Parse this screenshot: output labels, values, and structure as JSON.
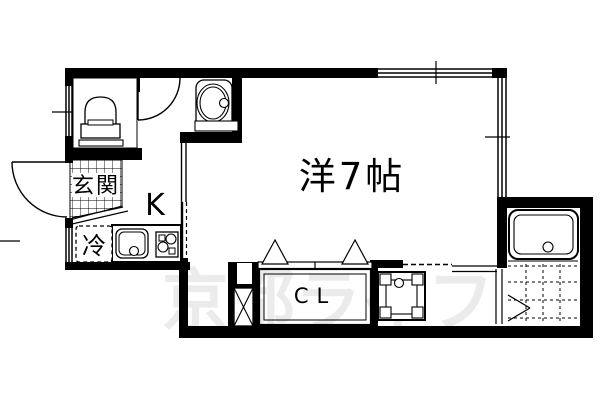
{
  "floor_plan": {
    "watermark": "京都ライフ",
    "rooms": {
      "main_room": {
        "label": "洋7帖"
      },
      "kitchen": {
        "label": "K"
      },
      "entrance": {
        "label": "玄関"
      },
      "closet": {
        "label": "CL"
      },
      "refrigerator": {
        "label": "冷"
      }
    },
    "colors": {
      "line": "#000000",
      "background": "#ffffff",
      "watermark": "#ebebeb"
    }
  }
}
